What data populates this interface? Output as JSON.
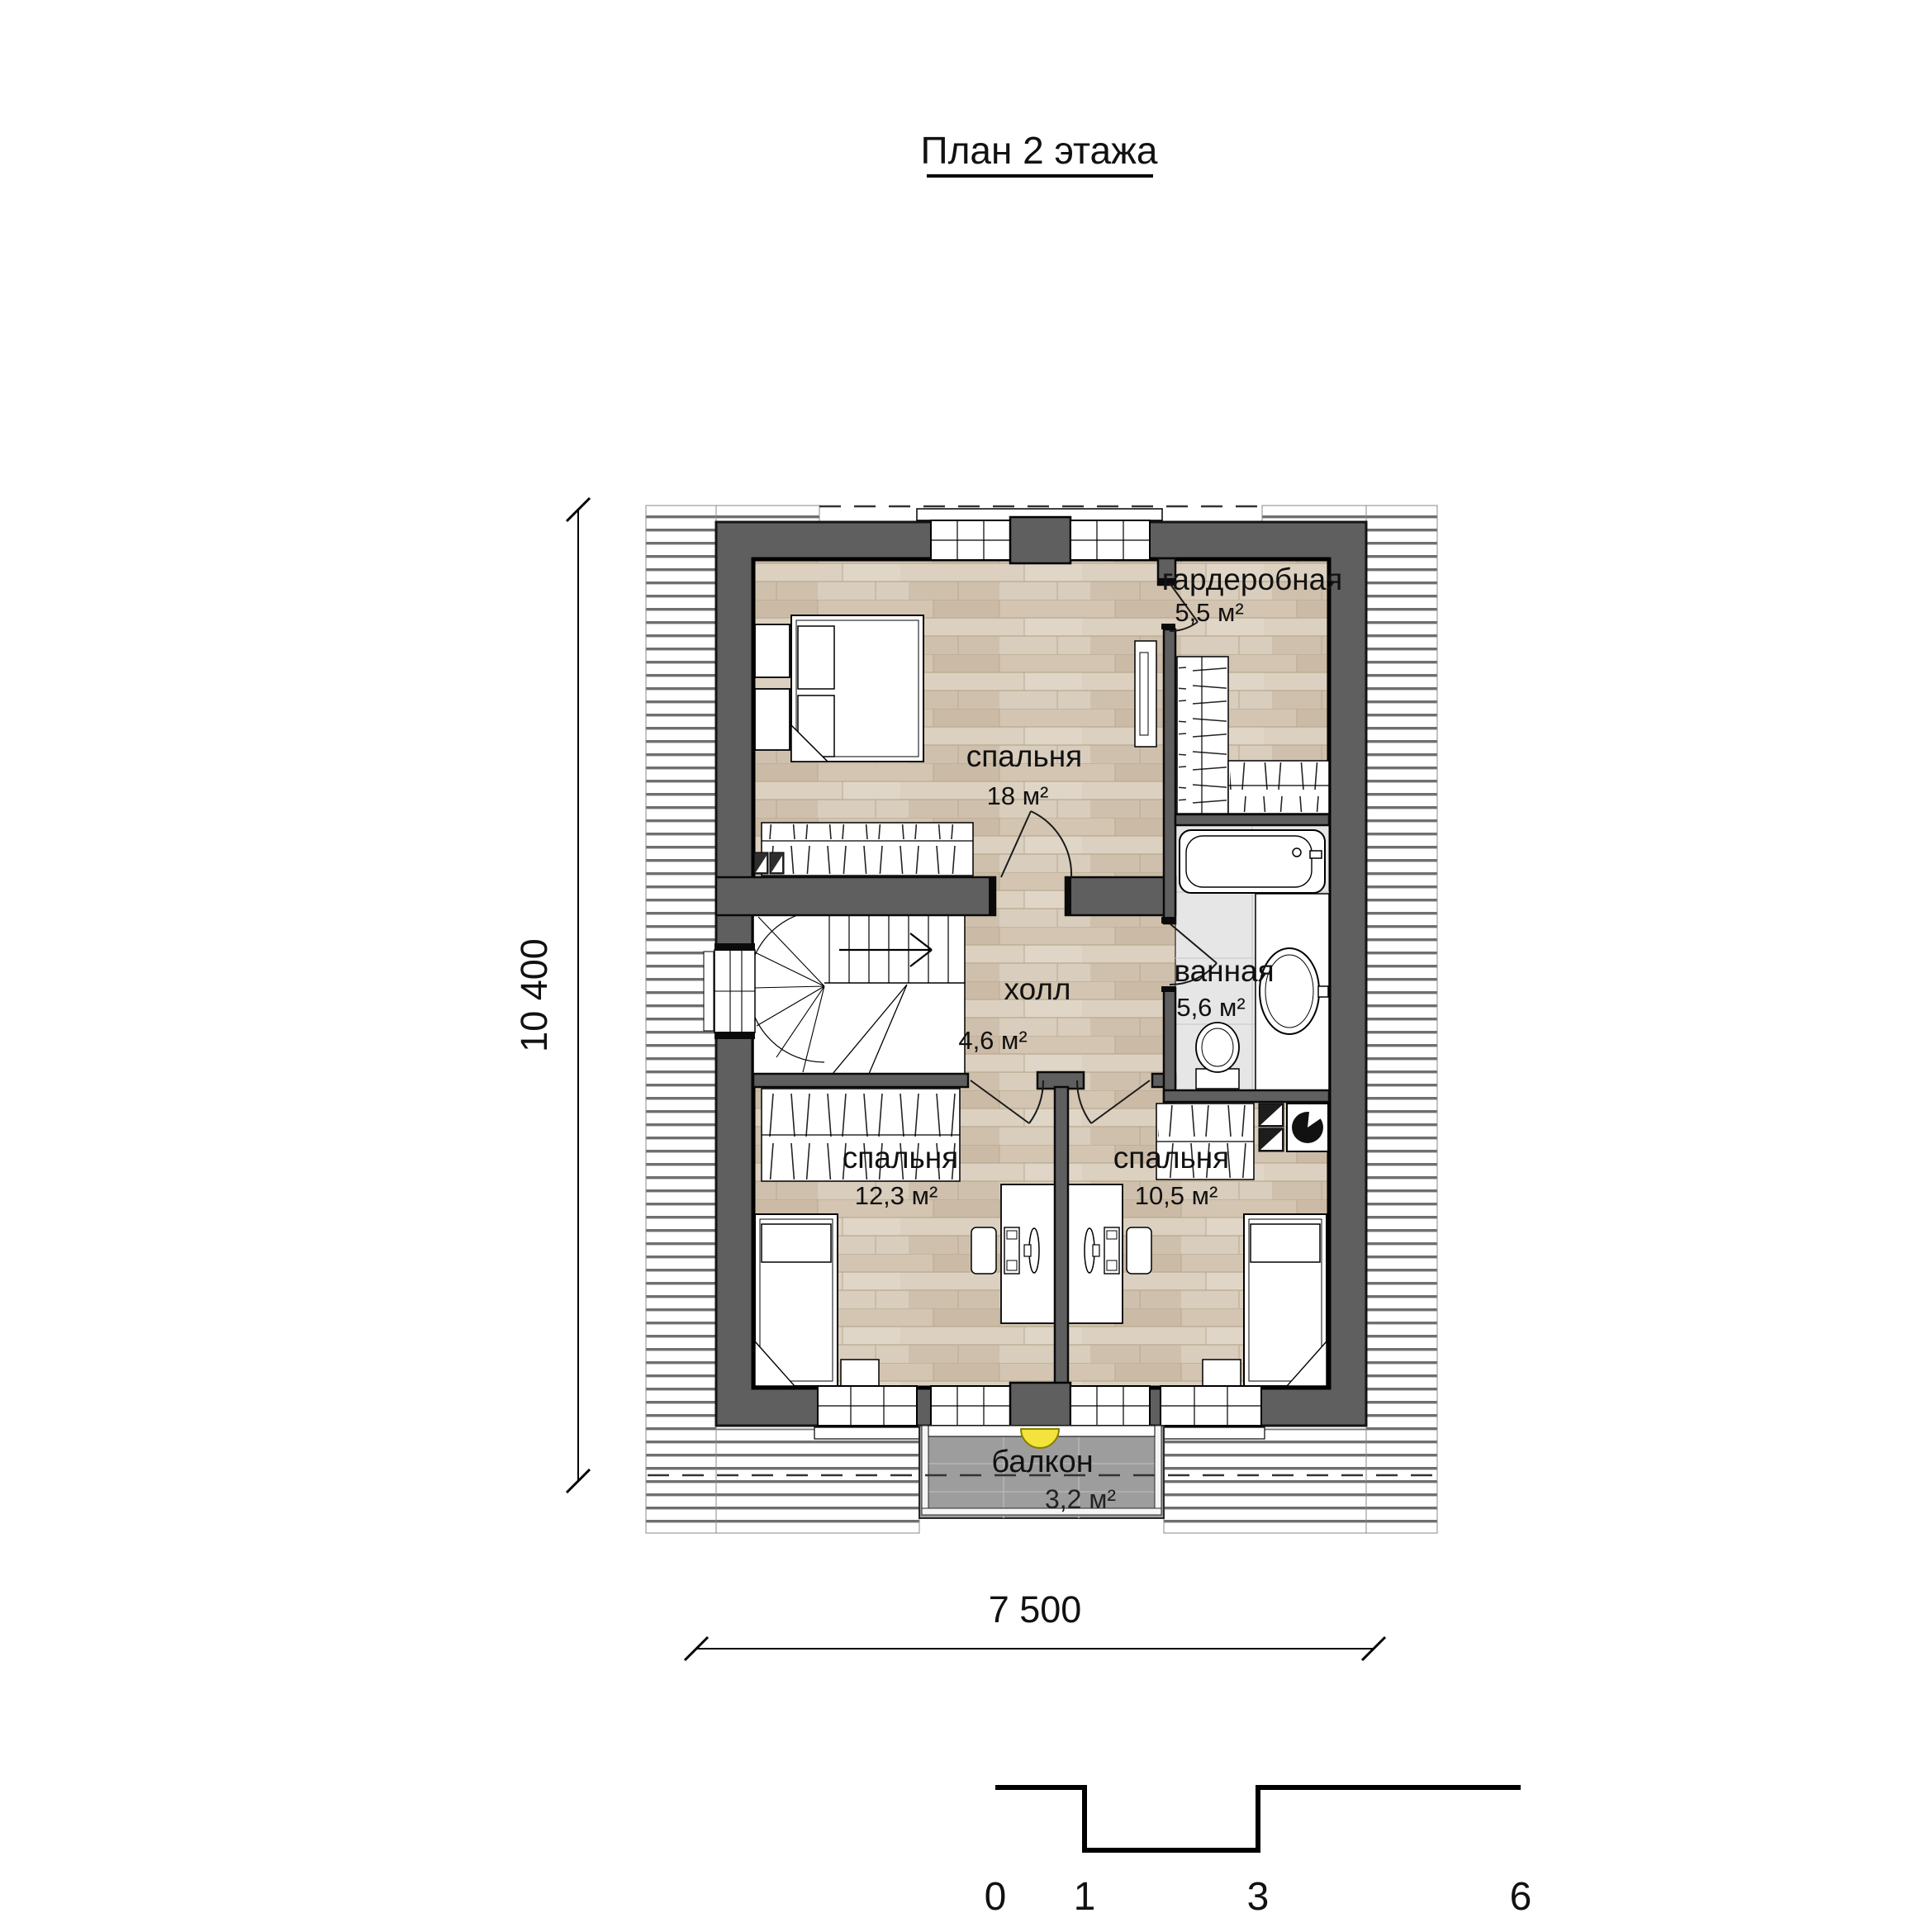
{
  "title": "План 2 этажа",
  "rooms": {
    "bedroom_main": {
      "name": "спальня",
      "area": "18 м²"
    },
    "wardrobe_room": {
      "name": "гардеробная",
      "area": "5,5 м²"
    },
    "bathroom": {
      "name": "ванная",
      "area": "5,6 м²"
    },
    "hall": {
      "name": "холл",
      "area": "4,6 м²"
    },
    "bedroom_left": {
      "name": "спальня",
      "area": "12,3 м²"
    },
    "bedroom_right": {
      "name": "спальня",
      "area": "10,5 м²"
    },
    "balcony": {
      "name": "балкон",
      "area": "3,2 м²"
    }
  },
  "dimensions": {
    "vertical": "10 400",
    "horizontal": "7 500"
  },
  "scale_bar": {
    "labels": [
      "0",
      "1",
      "3",
      "6"
    ]
  },
  "colors": {
    "wall": "#5f5f5f",
    "wood_floor": "#d8ccbc",
    "bath_tile": "#e6e6e6",
    "balcony_tile": "#9d9d9d",
    "lamp": "#f2e43c"
  }
}
